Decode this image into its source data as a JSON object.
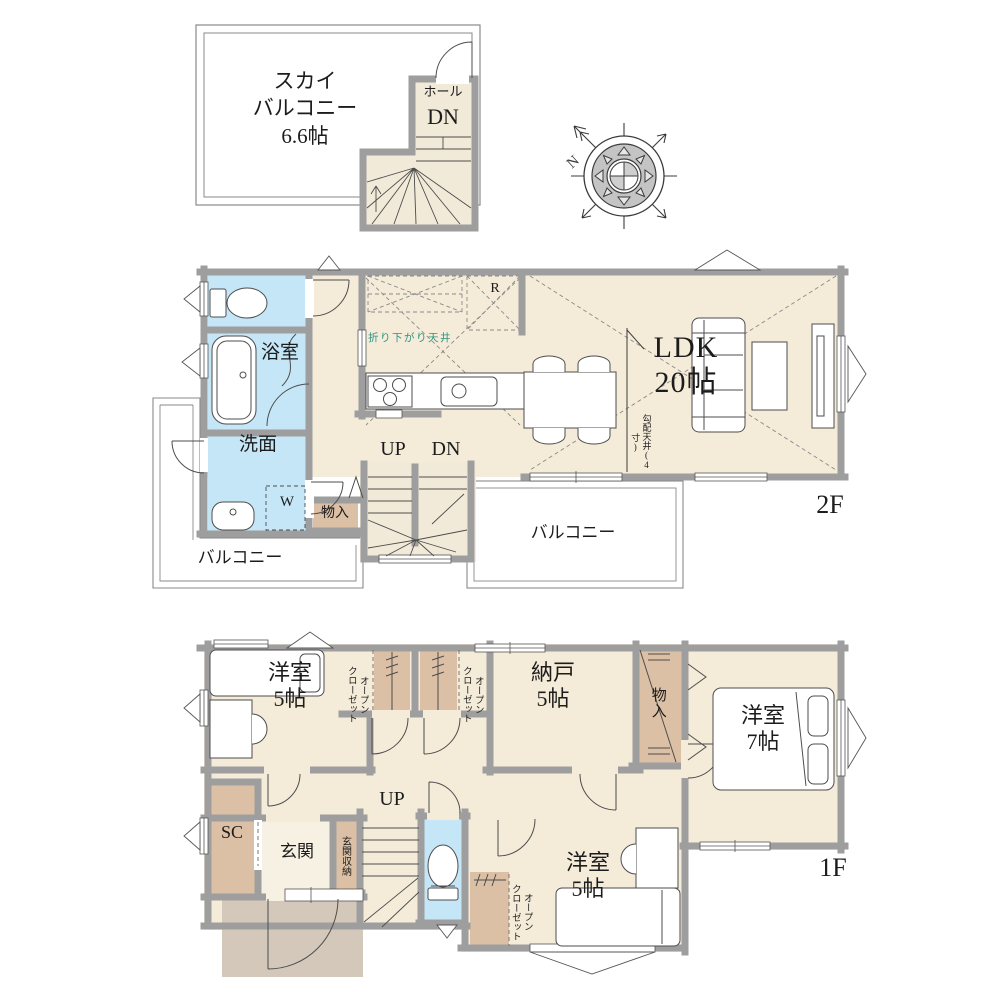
{
  "title": "間取り図",
  "compass": {
    "north": "N"
  },
  "colors": {
    "wall": "#9e9e9e",
    "floor_cream": "#f4ecd9",
    "stair_cream": "#f2ead8",
    "wet_blue": "#c5e6f7",
    "closet_tan": "#dcc0a5",
    "porch_greige": "#d4c8ba",
    "balcony_white": "#ffffff",
    "lowered_ceiling_text": "#2e9284",
    "line": "#4d4d4d"
  },
  "sky_floor": {
    "balcony_label": "スカイ\nバルコニー\n6.6帖",
    "hall_label": "ホール",
    "down_label": "DN"
  },
  "floor2": {
    "bath_label": "浴室",
    "washroom_label": "洗面",
    "washer_label": "W",
    "storage_label": "物入",
    "up_label": "UP",
    "down_label": "DN",
    "ldk_label": "LDK\n20帖",
    "lowered_ceiling_label": "折り下がり天井",
    "fridge_label": "R",
    "sloped_ceiling_label": "勾配天井(4寸)",
    "balcony_left_label": "バルコニー",
    "balcony_center_label": "バルコニー",
    "floor_label": "2F"
  },
  "floor1": {
    "room5_top_label": "洋室\n5帖",
    "open_closet_label": "オープン\nクローゼット",
    "nando_label": "納戸\n5帖",
    "storage_label": "物入",
    "room7_label": "洋室\n7帖",
    "up_label": "UP",
    "shoe_closet_label": "SC",
    "entrance_label": "玄関",
    "entrance_storage_label": "玄関収納",
    "room5_bottom_label": "洋室\n5帖",
    "floor_label": "1F"
  }
}
